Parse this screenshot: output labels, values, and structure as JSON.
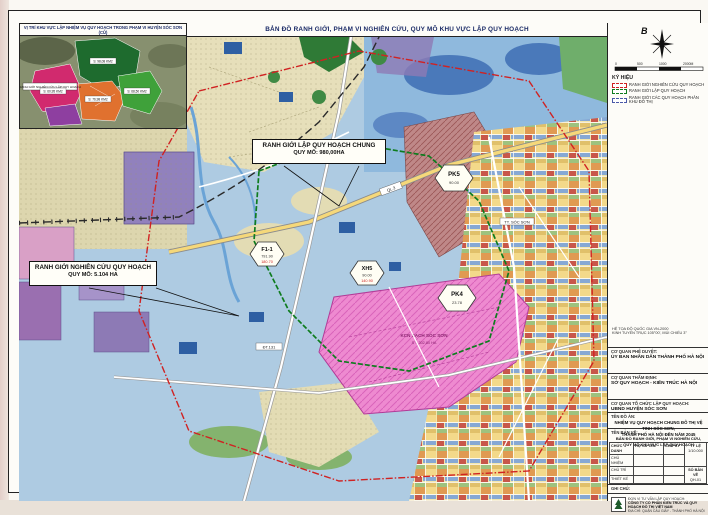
{
  "page": {
    "main_title": "BẢN ĐỒ RANH GIỚI, PHẠM VI NGHIÊN CỨU, QUY MÔ KHU VỰC LẬP QUY HOẠCH"
  },
  "inset": {
    "title": "VỊ TRÍ KHU VỰC LẬP NHIỆM VỤ QUY HOẠCH TRONG PHẠM VI HUYỆN SÓC SƠN (CŨ)",
    "boundary_label": "RANH GIỚI NGHIÊN CỨU LẬP QUY HOẠCH",
    "areas": {
      "green_dark": "S: 98,08 KM2",
      "crimson": "S: 60,95 KM2",
      "orange": "S: 76,98 KM2",
      "green": "S: 68,50 KM2"
    }
  },
  "callouts": {
    "main_line1": "RANH GIỚI LẬP QUY HOẠCH CHUNG",
    "main_line2": "QUY MÔ: 980,00HA",
    "study_line1": "RANH GIỚI NGHIÊN CỨU QUY HOẠCH",
    "study_line2": "QUY MÔ: 5.104 HA"
  },
  "markers": {
    "f11": {
      "id": "F1-1",
      "v1": "791.90",
      "v2": "180.70"
    },
    "xh5": {
      "id": "XH5",
      "v1": "90.00",
      "v2": "140.90"
    },
    "pk5": {
      "id": "PK5",
      "v1": "90.00"
    },
    "pk4": {
      "id": "PK4",
      "v1": "23.78"
    }
  },
  "map_labels": {
    "industrial1": "KCN SẠCH SÓC SƠN",
    "industrial2": "S = 302,80 HA",
    "road_ql3": "QL.3",
    "road_dt131": "ĐT.131",
    "town": "TT. SÓC SƠN"
  },
  "notes": {
    "s1_title": "1. PHẠM VI RANH GIỚI NGHIÊN CỨU QUY HOẠCH:",
    "s1_lines": [
      "PHẠM VI NGHIÊN CỨU LẬP QUY HOẠCH GỒM TOÀN BỘ ĐỊA GIỚI HÀNH CHÍNH CÁC XÃ: NỘI BÀI,",
      "TRUNG GIÃ, PHÙ LỖ, ĐA PHÚC, KIM ANH VÀ MỘT PHẦN CÁC XÃ LÂN CẬN THUỘC KHU VỰC HUYỆN",
      "SÓC SƠN (CŨ), THÀNH PHỐ HÀ NỘI. RANH GIỚI NGHIÊN CỨU ĐƯỢC XÁC ĐỊNH CỤ THỂ NHƯ SAU:",
      "-  PHÍA BẮC: GIÁP XÃ TRUNG GIÃ;",
      "-  PHÍA NAM: GIÁP XÃ QUANG TIẾN, XÃ PHÙ LINH;",
      "-  PHÍA ĐÔNG: GIÁP XÃ BẮC SƠN, XÃ ĐA PHÚC;",
      "-  PHÍA TÂY: GIÁP XÃ HIỀN NINH, XÃ THANH XUÂN;",
      "PHẠM VI, RANH GIỚI NGHIÊN CỨU QUY HOẠCH THEO RANH GIỚI HÀNH CHÍNH CÁC XÃ,",
      "QUY MÔ DIỆN TÍCH NGHIÊN CỨU LẬP NHIỆM VỤ QUY HOẠCH KHOẢNG 5.104 HA."
    ],
    "s2_title": "2. VỊ TRÍ, PHẠM VI RANH GIỚI LẬP QUY HOẠCH:",
    "s2_lines": [
      "PHẠM VI LẬP QUY HOẠCH CHUNG ĐÔ THỊ BÁM SÁT CÁC TUYẾN GIAO THÔNG CHÍNH KHU VỰC,",
      "TUYẾN ĐƯỜNG SẮT HÀ NỘI - THÁI NGUYÊN VÀ ĐỊA GIỚI HÀNH CHÍNH HIỆN HỮU CỦA CÁC XÃ",
      "THUỘC HUYỆN SÓC SƠN (CŨ), THÀNH PHỐ HÀ NỘI; ĐƯỢC GIỚI HẠN CỤ THỂ NHƯ SAU:",
      "-  PHÍA BẮC: GIÁP TUYẾN ĐƯỜNG SẮT HÀ NỘI - THÁI NGUYÊN;",
      "-  PHÍA ĐÔNG: GIÁP QUỐC LỘ 3 VÀ KHU DÂN CƯ HIỆN TRẠNG;",
      "-  PHÍA NAM: GIÁP ĐƯỜNG VÀNH ĐAI 4 VÀ XÃ PHÙ LỖ;",
      "-  PHÍA TÂY: GIÁP TUYẾN ĐƯỜNG NỐI QL.3 - ĐT.131;",
      "-  QUY MÔ LẬP QUY HOẠCH CHUNG: KHOẢNG 980,00 HA;",
      "-  DỰ BÁO QUY MÔ DÂN SỐ ĐẾN NĂM 2045: KHOẢNG 80.000 NGƯỜI."
    ]
  },
  "side": {
    "north_label": "B",
    "scale_ticks": [
      "0",
      "500",
      "1000",
      "2000M"
    ],
    "legend_title": "KÝ HIỆU",
    "legend": [
      "RANH GIỚI NGHIÊN CỨU QUY HOẠCH",
      "RANH GIỚI LẬP QUY HOẠCH",
      "RANH GIỚI CÁC QUY HOẠCH PHÂN KHU ĐÔ THỊ"
    ],
    "stamp": {
      "l1": "BAN QUẢN LÝ",
      "l2": "DỰ ÁN",
      "l3": "ĐẦU TƯ - HẠ TẦNG"
    },
    "coord_note1": "HỆ TỌA ĐỘ QUỐC GIA VN-2000",
    "coord_note2": "KINH TUYẾN TRỤC 105°00', MÚI CHIẾU 3°"
  },
  "titleblock": {
    "approve_label": "CƠ QUAN PHÊ DUYỆT:",
    "approve_value": "ỦY BAN NHÂN DÂN THÀNH PHỐ HÀ NỘI",
    "appraise_label": "CƠ QUAN THẨM ĐỊNH:",
    "appraise_value": "SỞ QUY HOẠCH - KIẾN TRÚC HÀ NỘI",
    "org_label": "CƠ QUAN TỔ CHỨC LẬP QUY HOẠCH:",
    "org_value": "UBND HUYỆN SÓC SƠN",
    "project_label": "TÊN ĐỒ ÁN:",
    "project_name1": "NHIỆM VỤ QUY HOẠCH CHUNG ĐÔ THỊ VỆ TINH SÓC SƠN,",
    "project_name2": "THÀNH PHỐ HÀ NỘI ĐẾN NĂM 2045",
    "drawing_label": "TÊN BẢN VẼ:",
    "drawing_name1": "BẢN ĐỒ RANH GIỚI, PHẠM VI NGHIÊN CỨU,",
    "drawing_name2": "QUY MÔ KHU VỰC LẬP QUY HOẠCH",
    "col_role": "CHỨC DANH",
    "col_name": "HỌ VÀ TÊN",
    "col_sign": "CHỮ KÝ",
    "rows": [
      {
        "role": "CHỦ NHIỆM"
      },
      {
        "role": "CHỦ TRÌ"
      },
      {
        "role": "THIẾT KẾ"
      }
    ],
    "scale_label": "TỶ LỆ",
    "scale_value": "1/10.000",
    "sheet_label": "SỐ BẢN VẼ",
    "sheet_value": "QH-01",
    "note_label": "GHI CHÚ:",
    "company_label": "ĐƠN VỊ TƯ VẤN LẬP QUY HOẠCH:",
    "company_name": "CÔNG TY CỔ PHẦN KIẾN TRÚC VÀ QUY HOẠCH ĐÔ THỊ VIỆT NAM",
    "company_addr": "ĐỊA CHỈ: QUẬN CẦU GIẤY - THÀNH PHỐ HÀ NỘI"
  }
}
